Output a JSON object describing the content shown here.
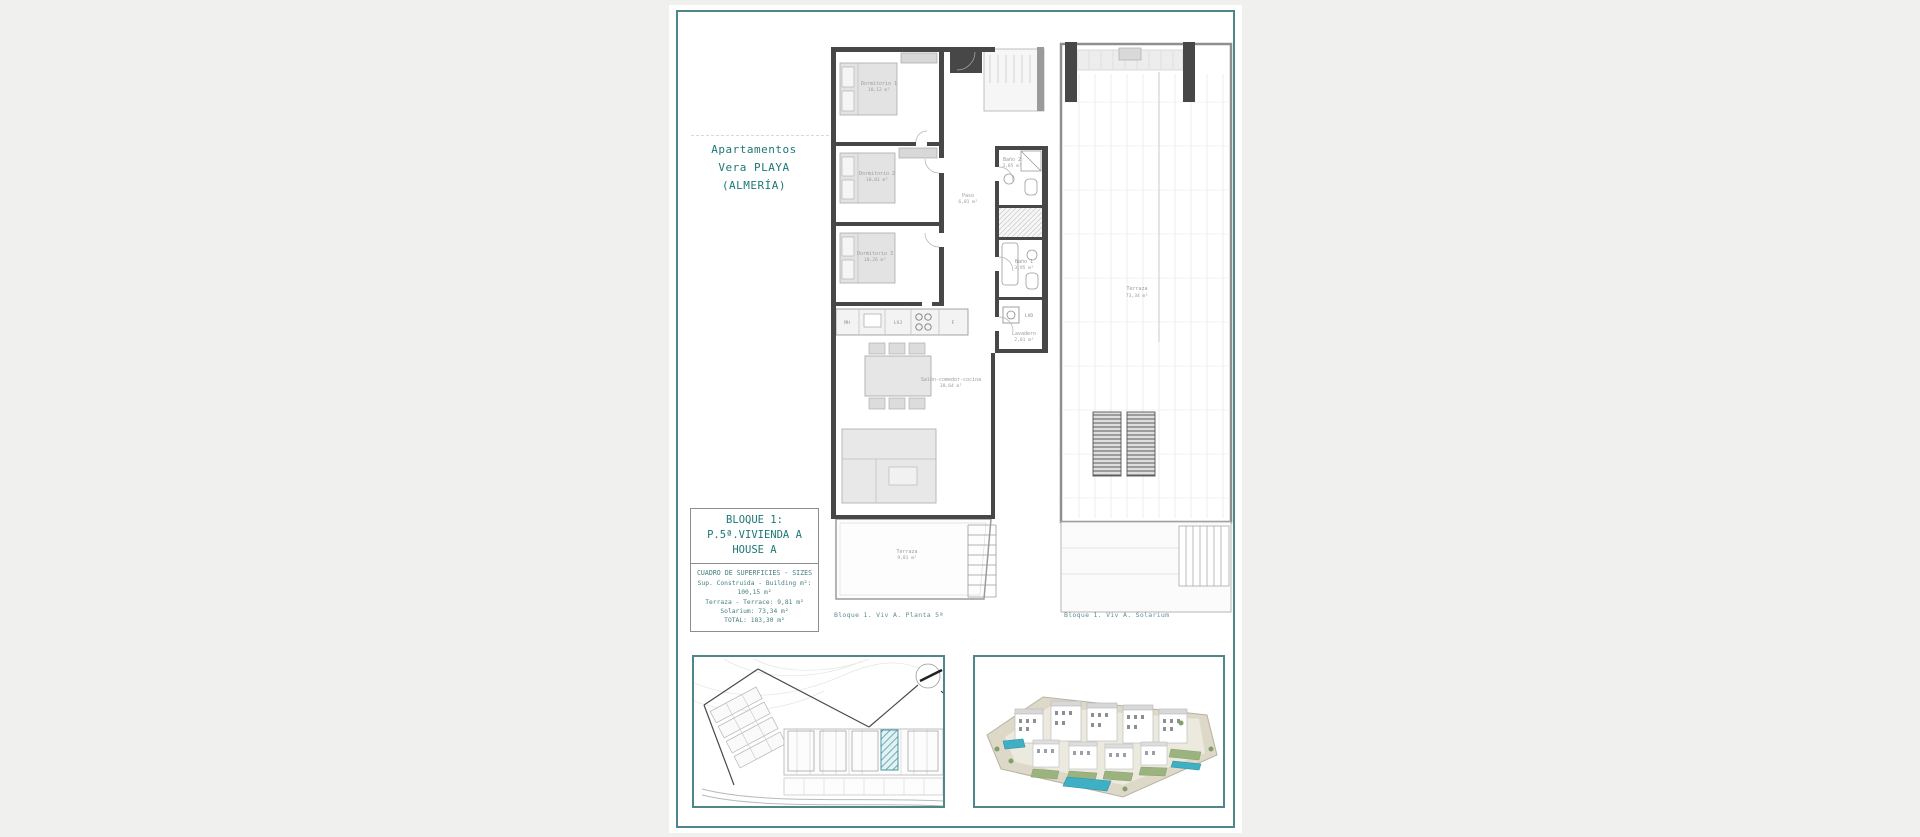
{
  "colors": {
    "background": "#f0f0ee",
    "page": "#ffffff",
    "accent_teal": "#1c7876",
    "border_teal": "#4f8689",
    "caption_teal": "#5f8e90",
    "wall_gray": "#474747",
    "highlight_hatch_teal": "#4e9aa8"
  },
  "header": {
    "title_lines": [
      "Apartamentos",
      "Vera PLAYA",
      "(ALMERÍA)"
    ]
  },
  "info_box": {
    "block": "BLOQUE 1:",
    "unit": "P.5ª.VIVIENDA A",
    "house": "HOUSE A"
  },
  "sizes_table": {
    "header": "CUADRO DE SUPERFICIES - SIZES",
    "rows": [
      "Sup. Construida - Building m²: 100,15 m²",
      "Terraza - Terrace: 9,81 m²",
      "Solarium: 73,34 m²",
      "TOTAL: 183,30 m²"
    ]
  },
  "floor_plan": {
    "caption": "Bloque 1. Viv A. Planta 5ª",
    "rooms": {
      "dormitorio1": {
        "name": "Dormitorio 1",
        "area": "10,12 m²"
      },
      "dormitorio2": {
        "name": "Dormitorio 2",
        "area": "10,01 m²"
      },
      "dormitorio3": {
        "name": "Dormitorio 3",
        "area": "10,26 m²"
      },
      "paso": {
        "name": "Paso",
        "area": "6,01 m²"
      },
      "bano2": {
        "name": "Baño 2",
        "area": "3,85 m²"
      },
      "bano1": {
        "name": "Baño 1",
        "area": "3,95 m²"
      },
      "lavadero": {
        "name": "Lavadero",
        "area": "2,01 m²"
      },
      "salon": {
        "name": "Salón-comedor-cocina",
        "area": "30,64 m²"
      },
      "terraza": {
        "name": "Terraza",
        "area": "9,81 m²"
      }
    },
    "appliances": {
      "mh": "MH",
      "lvj": "LVJ",
      "f": "F",
      "lvd": "LVD"
    }
  },
  "solarium_plan": {
    "caption": "Bloque 1. Viv A. Solarium",
    "terrace": {
      "name": "Terraza",
      "area": "73,34 m²"
    }
  }
}
